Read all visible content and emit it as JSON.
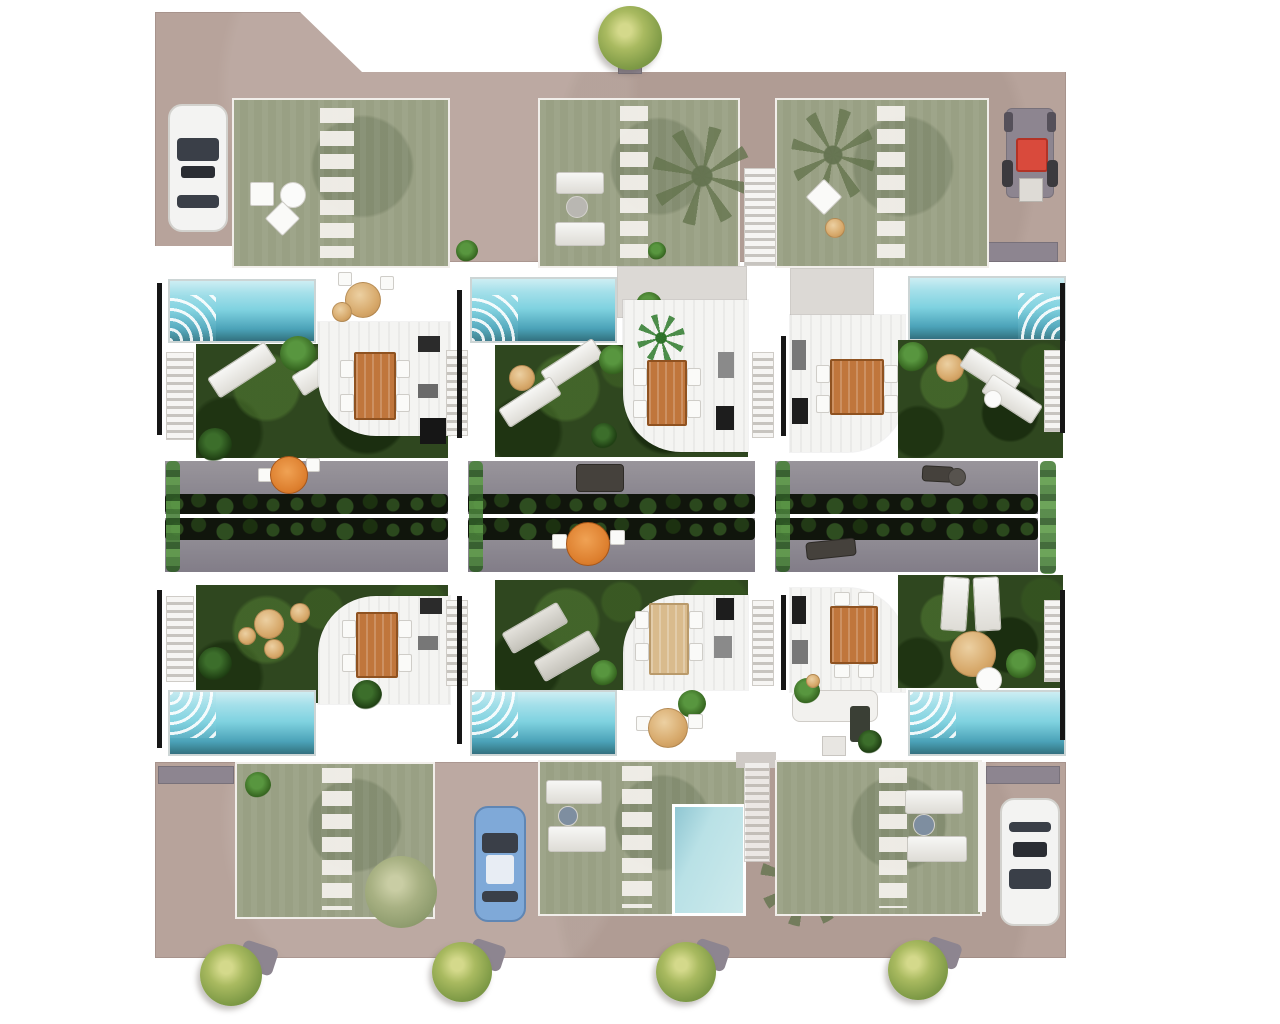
{
  "scene": {
    "title": "Villa development site plan",
    "description": "Top-down architectural render of a residential development: six attached villas in two rows of three, each with a private cyan swimming pool, dark green garden with sun loungers, white dining terrace with wooden table, central grey roof-terrace strip with hedges and patio furniture, washed-out roof gardens on beige terrain at top and bottom, parked cars, a tractor and street trees"
  },
  "counts": {
    "villas": 6,
    "villa_pools": 6,
    "small_pool_bottom": 1,
    "parked_cars": 3,
    "tractor": 1,
    "round_trees": 5,
    "palm_trees": 3,
    "dining_tables": 6,
    "roof_terrace_sections": 6
  },
  "colors": {
    "terrain": "#b7a39b",
    "garden-washed": "#99a084",
    "garden-dark": "#2f471f",
    "pool-light": "#cdeef3",
    "pool-mid": "#7fd2e0",
    "pool-deep": "#4ba2b8",
    "pool-border": "#ccd5d5",
    "pool-pale": "#b9e1e6",
    "terrace": "#f4f4f2",
    "patio-gray": "#dcd9d5",
    "road": "#8b8790",
    "hedge": "#10150c",
    "wall": "#161616",
    "wood-table": "#c0763c",
    "wood-table-dark": "#8f5220",
    "light-table": "#d9bb8d",
    "tan": "#d7a96b",
    "parasol": "#dd7f2e",
    "plant-green": "#58963f",
    "tree-green": "#a9ba60",
    "shed": "#8d8590",
    "car-white": "#f3f3f2",
    "car-blue": "#7fa9d8",
    "glass": "#3a3f48",
    "tractor-red": "#d94a3c"
  }
}
